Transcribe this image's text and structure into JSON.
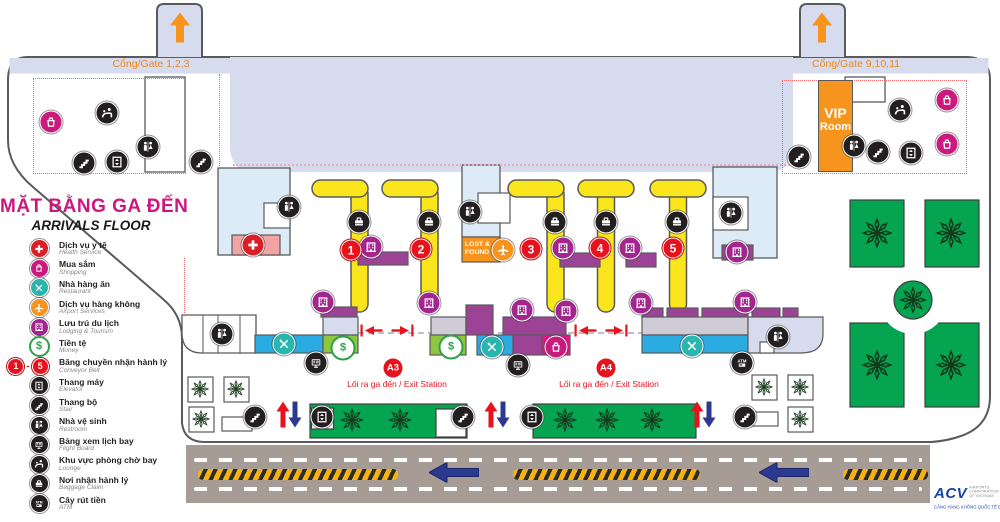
{
  "title": {
    "vn": "MẶT BẰNG GA ĐẾN",
    "en": "ARRIVALS FLOOR"
  },
  "gates": {
    "left": "Cổng/Gate 1,2,3",
    "right": "Cổng/Gate 9,10,11"
  },
  "vip": {
    "line1": "VIP",
    "line2": "Room"
  },
  "lost_found": {
    "line1": "LOST &",
    "line2": "FOUND"
  },
  "exits": [
    {
      "id": "A3",
      "label": "Lối ra ga đến / Exit Station"
    },
    {
      "id": "A4",
      "label": "Lối ra ga đến / Exit Station"
    }
  ],
  "logo": {
    "name": "ACV",
    "sub1": "AIRPORTS CORPORATION OF VIETNAM",
    "sub2": "CẢNG HÀNG KHÔNG QUỐC TẾ ĐÀ NẴNG"
  },
  "colors": {
    "accent_magenta": "#ec0f8a",
    "purple": "#9c4396",
    "blue": "#2aabe2",
    "money_green": "#8ec63f",
    "garden_green": "#04a451",
    "orange": "#f7941d",
    "red": "#e8121d",
    "yellow": "#fbe51d",
    "lavender": "#d6dcee",
    "room_blue": "#dcebf6",
    "road": "#a69c95",
    "nav_blue": "#2b3990"
  },
  "legend": {
    "items": [
      {
        "type": "medical",
        "vn": "Dịch vụ y tế",
        "en": "Health Service"
      },
      {
        "type": "shopping",
        "vn": "Mua sắm",
        "en": "Shopping"
      },
      {
        "type": "restaurant",
        "vn": "Nhà hàng ăn",
        "en": "Restaurant"
      },
      {
        "type": "airport",
        "vn": "Dịch vụ hàng không",
        "en": "Airport Services"
      },
      {
        "type": "lodging",
        "vn": "Lưu trú du lịch",
        "en": "Lodging & Tourism"
      },
      {
        "type": "money",
        "vn": "Tiền tệ",
        "en": "Money"
      },
      {
        "type": "conveyor",
        "vn": "Băng chuyền nhận hành lý",
        "en": "Conveyor Belt",
        "from": "1",
        "to": "5"
      },
      {
        "type": "elevator",
        "vn": "Thang máy",
        "en": "Elevator"
      },
      {
        "type": "stairs",
        "vn": "Thang bộ",
        "en": "Stair"
      },
      {
        "type": "restroom",
        "vn": "Nhà vệ sinh",
        "en": "Restroom"
      },
      {
        "type": "flightboard",
        "vn": "Bảng xem lịch bay",
        "en": "Flight Board"
      },
      {
        "type": "lounge",
        "vn": "Khu vực phòng chờ bay",
        "en": "Lounge"
      },
      {
        "type": "baggage",
        "vn": "Nơi nhận hành lý",
        "en": "Baggage Claim"
      },
      {
        "type": "atm",
        "vn": "Cây rút tiền",
        "en": "ATM"
      }
    ]
  },
  "map": {
    "icons": [
      {
        "t": "shopping",
        "x": 51,
        "y": 122
      },
      {
        "t": "lounge",
        "x": 107,
        "y": 113
      },
      {
        "t": "stairs",
        "x": 84,
        "y": 163
      },
      {
        "t": "elevator",
        "x": 117,
        "y": 162
      },
      {
        "t": "restroom",
        "x": 148,
        "y": 147
      },
      {
        "t": "stairs",
        "x": 201,
        "y": 162
      },
      {
        "t": "lounge",
        "x": 900,
        "y": 110
      },
      {
        "t": "stairs",
        "x": 799,
        "y": 157
      },
      {
        "t": "restroom",
        "x": 854,
        "y": 146
      },
      {
        "t": "stairs",
        "x": 878,
        "y": 152
      },
      {
        "t": "elevator",
        "x": 911,
        "y": 153
      },
      {
        "t": "shopping",
        "x": 947,
        "y": 100
      },
      {
        "t": "shopping",
        "x": 947,
        "y": 144
      },
      {
        "t": "baggage",
        "x": 359,
        "y": 222
      },
      {
        "t": "baggage",
        "x": 429,
        "y": 222
      },
      {
        "t": "baggage",
        "x": 555,
        "y": 222
      },
      {
        "t": "baggage",
        "x": 606,
        "y": 222
      },
      {
        "t": "baggage",
        "x": 677,
        "y": 222
      },
      {
        "t": "restroom",
        "x": 470,
        "y": 212
      },
      {
        "t": "airport",
        "x": 503,
        "y": 250
      },
      {
        "t": "restroom",
        "x": 289,
        "y": 207
      },
      {
        "t": "medical",
        "x": 253,
        "y": 245
      },
      {
        "t": "restroom",
        "x": 731,
        "y": 213
      },
      {
        "t": "lodging",
        "x": 737,
        "y": 252
      },
      {
        "t": "lodging",
        "x": 371,
        "y": 247
      },
      {
        "t": "lodging",
        "x": 563,
        "y": 248
      },
      {
        "t": "lodging",
        "x": 630,
        "y": 248
      },
      {
        "t": "restroom",
        "x": 222,
        "y": 334
      },
      {
        "t": "restaurant",
        "x": 284,
        "y": 344
      },
      {
        "t": "lodging",
        "x": 323,
        "y": 302
      },
      {
        "t": "money",
        "x": 343,
        "y": 348
      },
      {
        "t": "flightboard",
        "x": 316,
        "y": 363
      },
      {
        "t": "lodging",
        "x": 429,
        "y": 303
      },
      {
        "t": "lodging",
        "x": 522,
        "y": 310
      },
      {
        "t": "lodging",
        "x": 566,
        "y": 311
      },
      {
        "t": "money",
        "x": 451,
        "y": 347
      },
      {
        "t": "restaurant",
        "x": 492,
        "y": 347
      },
      {
        "t": "shopping",
        "x": 556,
        "y": 347
      },
      {
        "t": "flightboard",
        "x": 518,
        "y": 365
      },
      {
        "t": "lodging",
        "x": 641,
        "y": 303
      },
      {
        "t": "lodging",
        "x": 745,
        "y": 302
      },
      {
        "t": "restaurant",
        "x": 692,
        "y": 346
      },
      {
        "t": "restroom",
        "x": 778,
        "y": 337
      },
      {
        "t": "atm",
        "x": 742,
        "y": 363
      },
      {
        "t": "stairs",
        "x": 255,
        "y": 417
      },
      {
        "t": "elevator",
        "x": 322,
        "y": 417
      },
      {
        "t": "stairs",
        "x": 463,
        "y": 417
      },
      {
        "t": "elevator",
        "x": 532,
        "y": 417
      },
      {
        "t": "stairs",
        "x": 745,
        "y": 417
      }
    ],
    "trees": [
      {
        "x": 200,
        "y": 389,
        "s": 20
      },
      {
        "x": 236,
        "y": 389,
        "s": 20
      },
      {
        "x": 201,
        "y": 419,
        "s": 20
      },
      {
        "x": 764,
        "y": 387,
        "s": 20
      },
      {
        "x": 800,
        "y": 387,
        "s": 20
      },
      {
        "x": 800,
        "y": 419,
        "s": 20
      },
      {
        "x": 352,
        "y": 420,
        "s": 26
      },
      {
        "x": 400,
        "y": 420,
        "s": 26
      },
      {
        "x": 565,
        "y": 420,
        "s": 26
      },
      {
        "x": 607,
        "y": 420,
        "s": 26
      },
      {
        "x": 652,
        "y": 420,
        "s": 26
      },
      {
        "x": 877,
        "y": 233,
        "s": 34
      },
      {
        "x": 951,
        "y": 233,
        "s": 34
      },
      {
        "x": 877,
        "y": 365,
        "s": 34
      },
      {
        "x": 951,
        "y": 365,
        "s": 34
      },
      {
        "x": 913,
        "y": 300,
        "s": 30
      }
    ],
    "numbers": [
      {
        "n": "1",
        "x": 351,
        "y": 250
      },
      {
        "n": "2",
        "x": 421,
        "y": 249
      },
      {
        "n": "3",
        "x": 531,
        "y": 249
      },
      {
        "n": "4",
        "x": 600,
        "y": 248
      },
      {
        "n": "5",
        "x": 673,
        "y": 248
      }
    ],
    "arrows": [
      {
        "t": "orange-up",
        "x": 180,
        "y": 30
      },
      {
        "t": "orange-up",
        "x": 822,
        "y": 30
      },
      {
        "t": "red-up",
        "x": 283,
        "y": 417
      },
      {
        "t": "blue-down",
        "x": 295,
        "y": 417
      },
      {
        "t": "red-up",
        "x": 491,
        "y": 417
      },
      {
        "t": "blue-down",
        "x": 503,
        "y": 417
      },
      {
        "t": "red-up",
        "x": 697,
        "y": 417
      },
      {
        "t": "blue-down",
        "x": 709,
        "y": 417
      },
      {
        "t": "road-left",
        "x": 454,
        "y": 475
      },
      {
        "t": "road-left",
        "x": 784,
        "y": 475
      },
      {
        "t": "exit-marker",
        "x": 387,
        "y": 333
      },
      {
        "t": "exit-marker",
        "x": 601,
        "y": 333
      }
    ]
  }
}
